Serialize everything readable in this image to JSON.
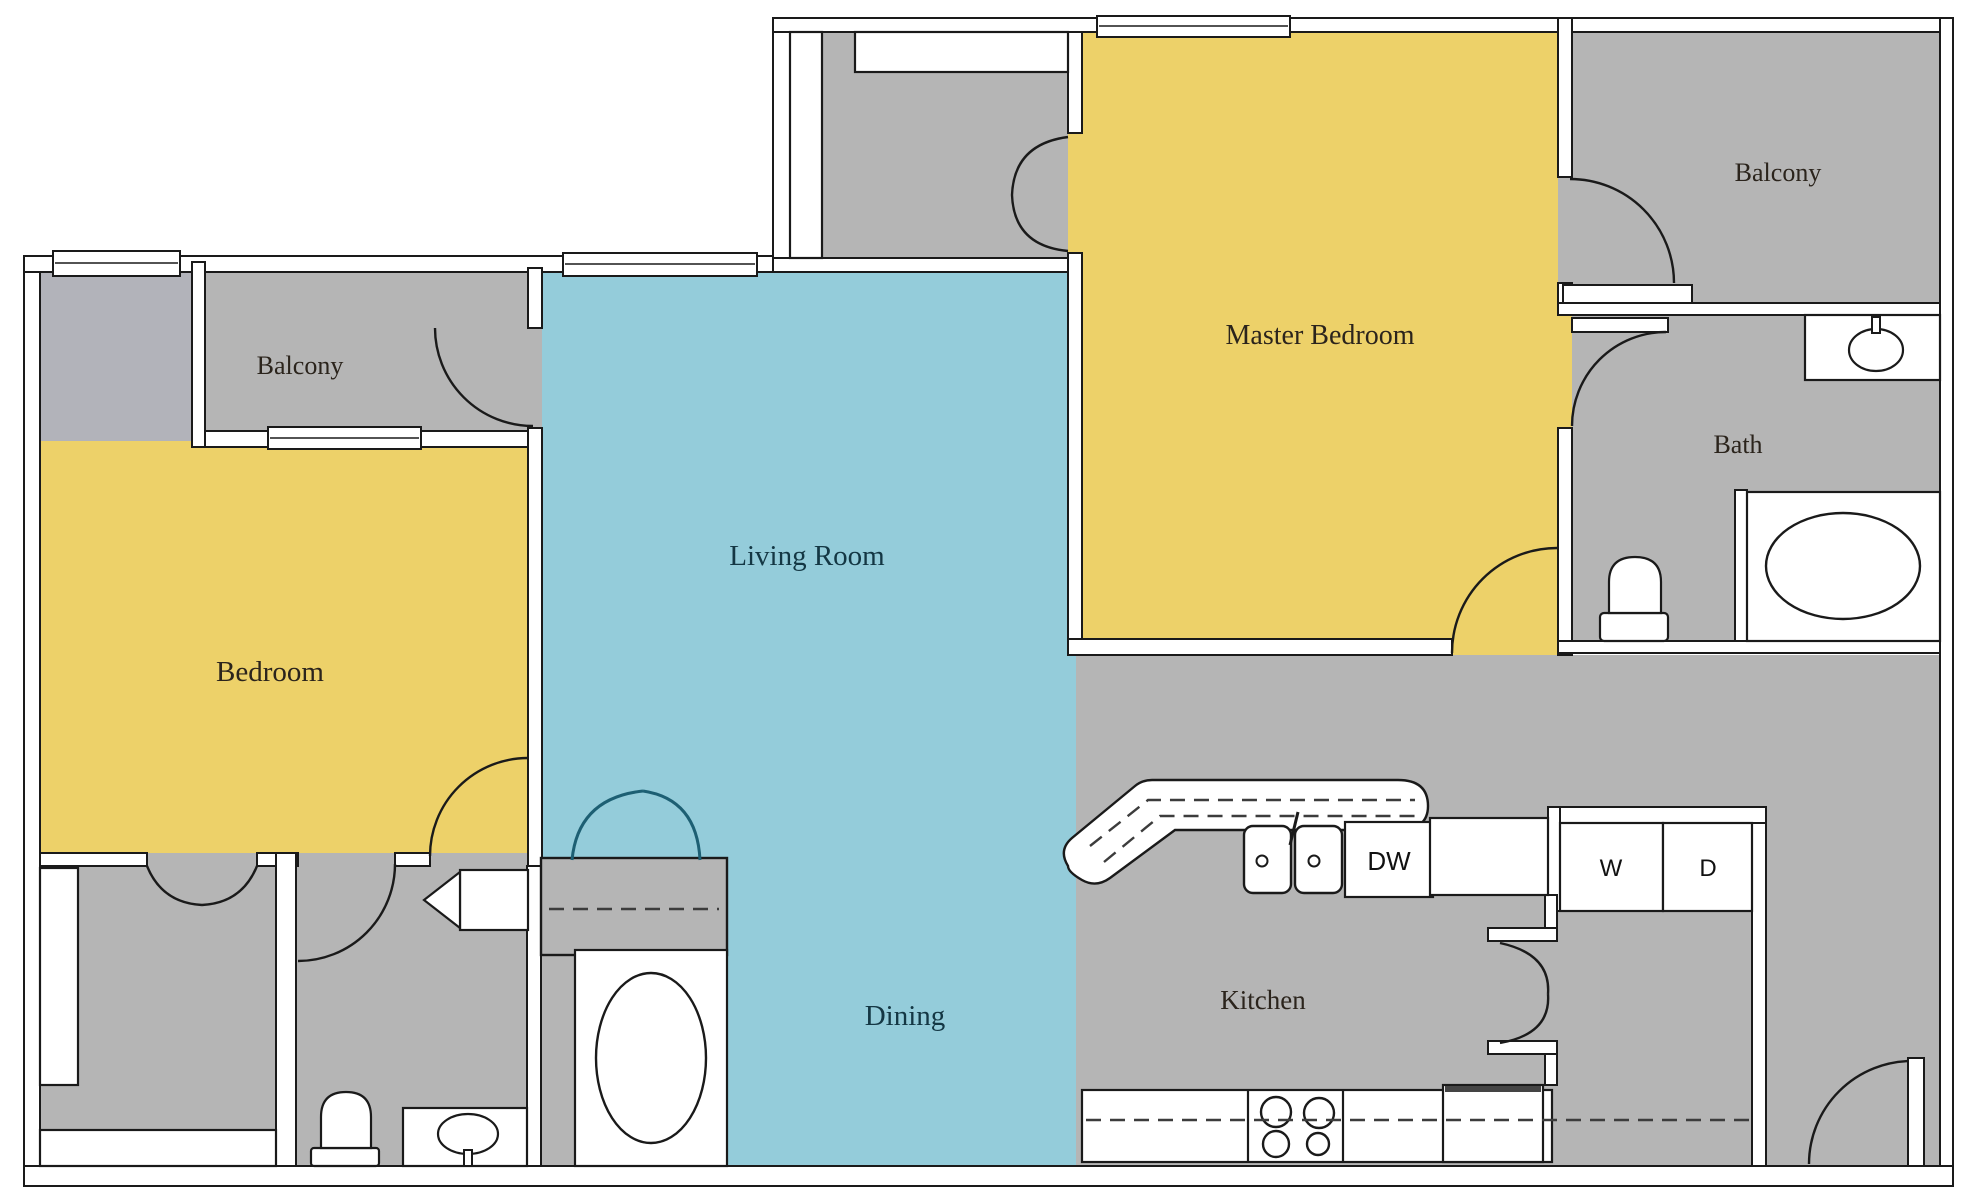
{
  "rooms": {
    "balcony_left": {
      "label": "Balcony"
    },
    "bedroom": {
      "label": "Bedroom"
    },
    "living_room": {
      "label": "Living Room"
    },
    "dining": {
      "label": "Dining"
    },
    "master_bedroom": {
      "label": "Master Bedroom"
    },
    "balcony_right": {
      "label": "Balcony"
    },
    "bath": {
      "label": "Bath"
    },
    "kitchen": {
      "label": "Kitchen"
    }
  },
  "appliances": {
    "dishwasher": "DW",
    "washer": "W",
    "dryer": "D"
  },
  "colors": {
    "bedroom_yellow": "#edd169",
    "living_blue": "#94ccda",
    "room_gray": "#b5b5b5",
    "strip_gray": "#b2b3ba",
    "wall_fill": "#ffffff",
    "line": "#1a1a1a",
    "door_accent_teal": "#1d5f73"
  }
}
